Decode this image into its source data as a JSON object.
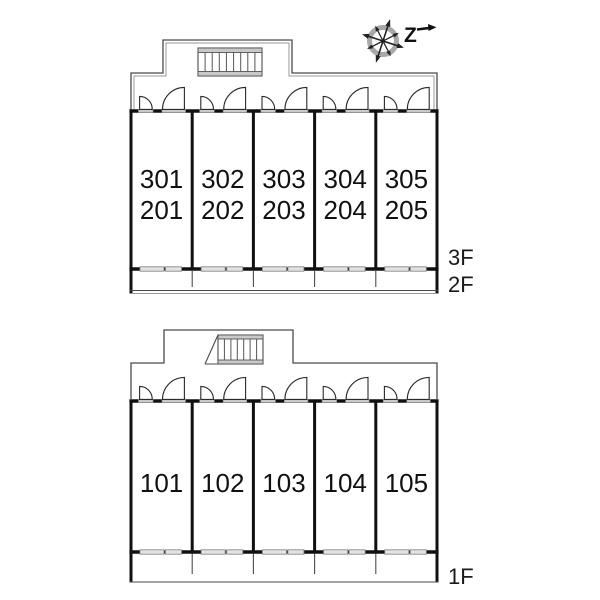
{
  "compass": {
    "label": "Z"
  },
  "upper_building": {
    "floor_labels": [
      "3F",
      "2F"
    ],
    "units": [
      {
        "row1": "301",
        "row2": "201"
      },
      {
        "row1": "302",
        "row2": "202"
      },
      {
        "row1": "303",
        "row2": "203"
      },
      {
        "row1": "304",
        "row2": "204"
      },
      {
        "row1": "305",
        "row2": "205"
      }
    ]
  },
  "lower_building": {
    "floor_labels": [
      "1F"
    ],
    "units": [
      {
        "label": "101"
      },
      {
        "label": "102"
      },
      {
        "label": "103"
      },
      {
        "label": "104"
      },
      {
        "label": "105"
      }
    ]
  },
  "colors": {
    "line": "#101010",
    "outline": "#4a4a4a",
    "light_outline": "#9a9a9a",
    "gray_fill": "#c9c9c9",
    "window_fill": "#e2e2e2"
  }
}
